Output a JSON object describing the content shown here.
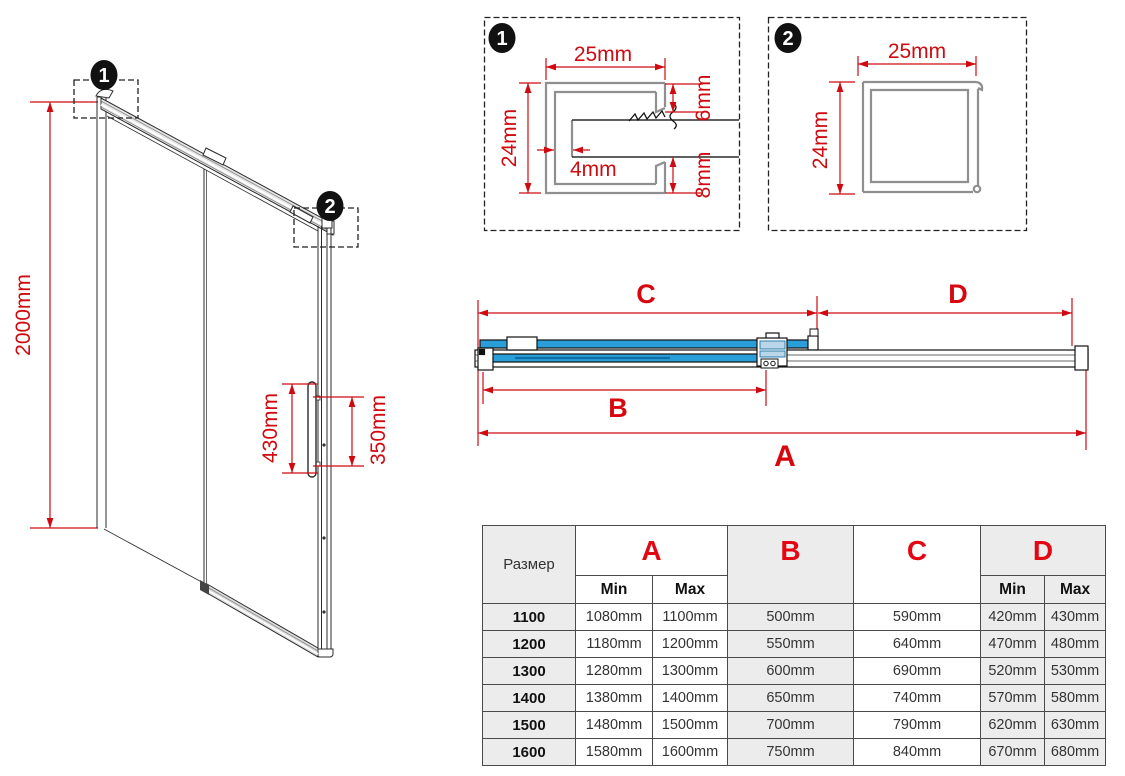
{
  "colors": {
    "dimension_red": "#cf0a10",
    "table_letter_red": "#e30613",
    "glass_blue": "#2a9ed9"
  },
  "isometric": {
    "callout_1": "1",
    "callout_2": "2",
    "height_dim": "2000mm",
    "handle_dim": "430mm",
    "handle_hole_dim": "350mm"
  },
  "detail_1": {
    "badge": "1",
    "width_dim": "25mm",
    "height_dim": "24mm",
    "top_lip_dim": "6mm",
    "wall_dim": "4mm",
    "bottom_lip_dim": "8mm"
  },
  "detail_2": {
    "badge": "2",
    "width_dim": "25mm",
    "height_dim": "24mm"
  },
  "top_view": {
    "label_a": "A",
    "label_b": "B",
    "label_c": "C",
    "label_d": "D"
  },
  "table": {
    "size_header": "Размер",
    "col_a": "A",
    "col_b": "B",
    "col_c": "C",
    "col_d": "D",
    "min_label": "Min",
    "max_label": "Max",
    "min_label_d": "Min",
    "max_label_d": "Max",
    "rows": [
      {
        "size": "1100",
        "a_min": "1080mm",
        "a_max": "1100mm",
        "b": "500mm",
        "c": "590mm",
        "d_min": "420mm",
        "d_max": "430mm"
      },
      {
        "size": "1200",
        "a_min": "1180mm",
        "a_max": "1200mm",
        "b": "550mm",
        "c": "640mm",
        "d_min": "470mm",
        "d_max": "480mm"
      },
      {
        "size": "1300",
        "a_min": "1280mm",
        "a_max": "1300mm",
        "b": "600mm",
        "c": "690mm",
        "d_min": "520mm",
        "d_max": "530mm"
      },
      {
        "size": "1400",
        "a_min": "1380mm",
        "a_max": "1400mm",
        "b": "650mm",
        "c": "740mm",
        "d_min": "570mm",
        "d_max": "580mm"
      },
      {
        "size": "1500",
        "a_min": "1480mm",
        "a_max": "1500mm",
        "b": "700mm",
        "c": "790mm",
        "d_min": "620mm",
        "d_max": "630mm"
      },
      {
        "size": "1600",
        "a_min": "1580mm",
        "a_max": "1600mm",
        "b": "750mm",
        "c": "840mm",
        "d_min": "670mm",
        "d_max": "680mm"
      }
    ]
  }
}
